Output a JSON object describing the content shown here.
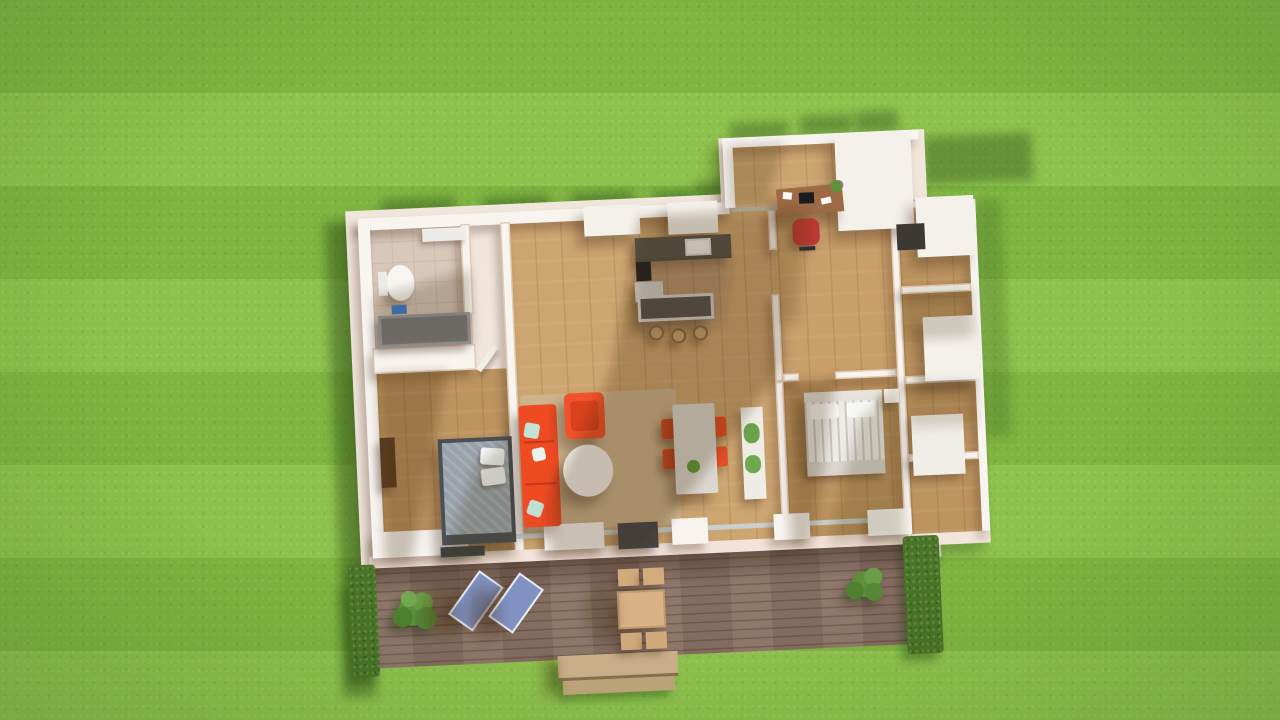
{
  "scene": {
    "type": "3d-architectural-render",
    "view": "top-down-aerial",
    "subject": "furnished single-story house floor plan on a striped lawn with rear wooden deck"
  },
  "palette": {
    "grass_base": "#8ac046",
    "grass_shadow": "#1e3c10",
    "roof_trim": "#f1e6dc",
    "wall_white": "#f8f5f0",
    "sill_pink": "#f3e2d8",
    "wood_floor": "#c89e6a",
    "wood_floor_light": "#cda571",
    "wood_floor_dark": "#bd9460",
    "tile_floor": "#d9c8ba",
    "deck_wood": "#8b7265",
    "rug_beige": "#cdb48d",
    "sofa_red": "#ee4b23",
    "armchair_red": "#f1522a",
    "dining_chair_red": "#e64e28",
    "office_chair_red": "#b93a31",
    "bed1_frame": "#4b5056",
    "bed1_mattress": "#99a1a9",
    "bed2_duvet": "#edece8",
    "pillow_white": "#f2f4f5",
    "counter_dark": "#56544b",
    "island_dark": "#5b584e",
    "stool_wood": "#c9a578",
    "table_gray": "#dcd8d1",
    "cabinet_white": "#efece6",
    "tub_gray": "#7b7b80",
    "tv_dark": "#45484d",
    "wardrobe_brown": "#5e4026",
    "lounger_blue": "#8092c2",
    "outdoor_wood": "#dab286",
    "step_wood": "#cdb28a",
    "hedge_green": "#4a7427",
    "bush_green": "#5d8f3a",
    "plant_green": "#68a249",
    "cast_shadow": "#3a2412"
  },
  "lawn": {
    "stripe_height_px": 93,
    "stripe_pattern": "horizontal-mow-bands"
  },
  "house": {
    "rooms": [
      {
        "name": "bathroom",
        "floor": "beige-tile",
        "furniture": [
          "toilet",
          "bathtub",
          "vanity",
          "blue-bath-mat"
        ]
      },
      {
        "name": "bedroom-left",
        "floor": "wood",
        "furniture": [
          "double-bed-gray",
          "white-pillows-2",
          "wardrobe",
          "bench"
        ]
      },
      {
        "name": "living-room",
        "floor": "wood",
        "furniture": [
          "red-sectional-sofa",
          "red-armchair",
          "oval-coffee-table",
          "beige-rug",
          "tv-unit"
        ]
      },
      {
        "name": "kitchen",
        "floor": "wood",
        "furniture": [
          "counter-with-sink",
          "cooktop",
          "tall-cabinet",
          "island",
          "bar-stools-3"
        ]
      },
      {
        "name": "dining-area",
        "floor": "wood",
        "furniture": [
          "dining-table",
          "red-chairs-4",
          "table-plant",
          "sideboard-with-plants"
        ]
      },
      {
        "name": "office-nook",
        "floor": "wood",
        "furniture": [
          "desk",
          "laptop",
          "papers",
          "desk-plant",
          "red-office-chair"
        ]
      },
      {
        "name": "bedroom-right",
        "floor": "wood",
        "furniture": [
          "double-bed-white-striped",
          "white-pillows-2",
          "nightstand",
          "dresser"
        ]
      },
      {
        "name": "entry-closet-wing",
        "floor": "wood",
        "furniture": [
          "doormat",
          "storage-cabinet"
        ]
      }
    ]
  },
  "deck": {
    "material": "brown-wood-planks",
    "items": [
      "blue-lounge-chair",
      "blue-lounge-chair",
      "outdoor-table",
      "outdoor-stools-4",
      "potted-bush-left",
      "potted-bush-right",
      "wood-steps",
      "hedge-left",
      "hedge-right"
    ]
  },
  "lighting": {
    "sun_direction": "top-right",
    "shadow_direction": "bottom-left"
  }
}
